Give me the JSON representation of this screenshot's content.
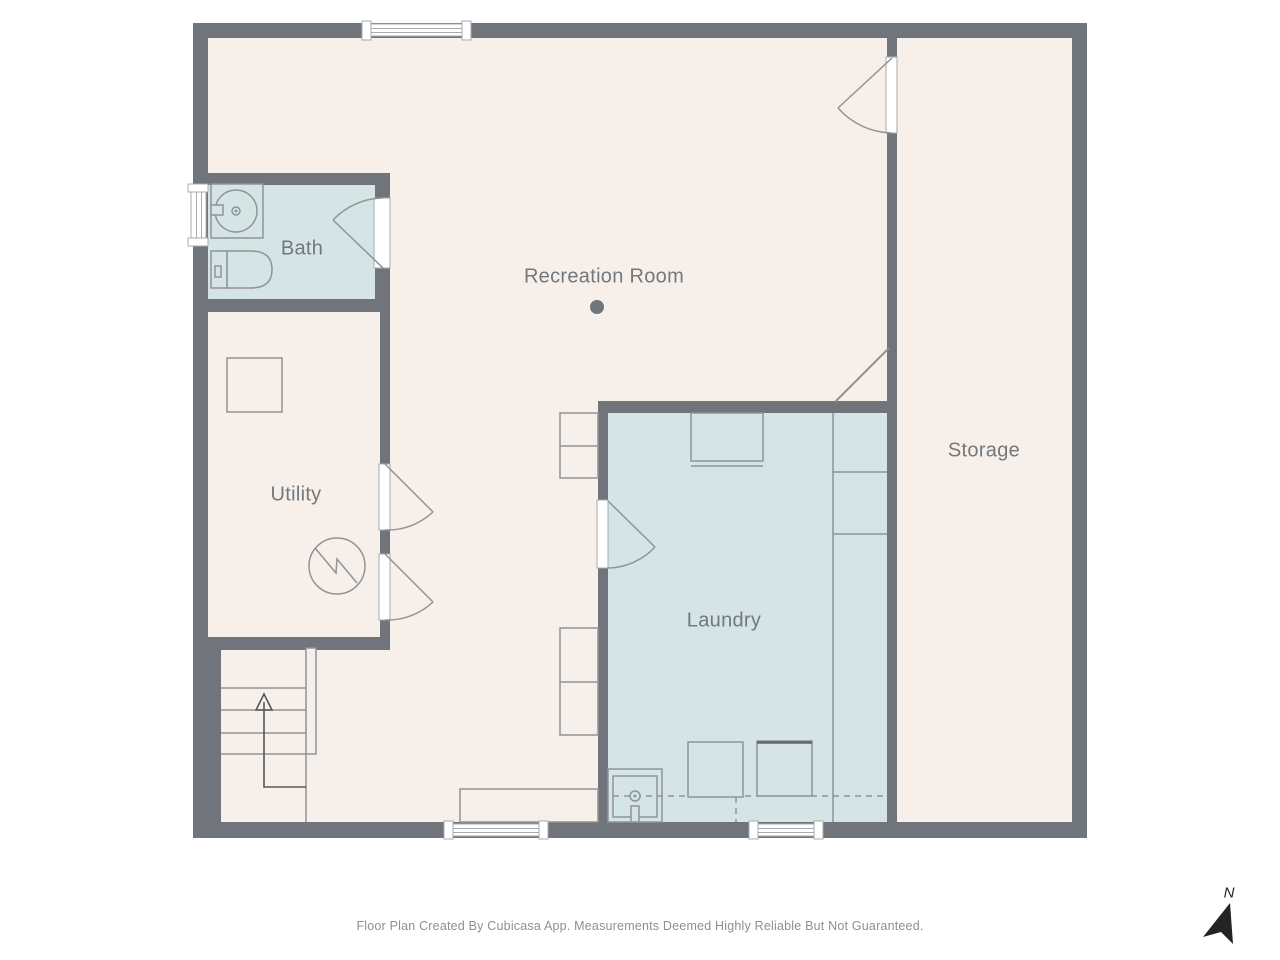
{
  "rooms": {
    "bath": {
      "label": "Bath"
    },
    "utility": {
      "label": "Utility"
    },
    "recreation": {
      "label": "Recreation Room"
    },
    "laundry": {
      "label": "Laundry"
    },
    "storage": {
      "label": "Storage"
    }
  },
  "compass": {
    "north_label": "N"
  },
  "footer": {
    "disclaimer": "Floor Plan Created By Cubicasa App. Measurements Deemed Highly Reliable But Not Guaranteed."
  },
  "icons": {
    "bath_sink": "bathroom-sink-icon",
    "toilet": "toilet-icon",
    "water_heater": "water-heater-icon",
    "electrical_panel": "electrical-panel-icon",
    "stairs": "stairs-up-icon",
    "laundry_sink": "laundry-sink-icon",
    "washer": "washer-icon",
    "dryer": "dryer-icon",
    "camera_point": "camera-point-icon",
    "north_arrow": "north-arrow-icon"
  },
  "colors": {
    "wall": "#6F757B",
    "floor": "#F7EFE9",
    "wet-room": "#D5E4E5",
    "fixture-stroke": "#8F9498",
    "label-text": "#73787D",
    "footer-text": "#8C9094",
    "compass": "#222426",
    "window-fill": "#FFFFFF"
  }
}
